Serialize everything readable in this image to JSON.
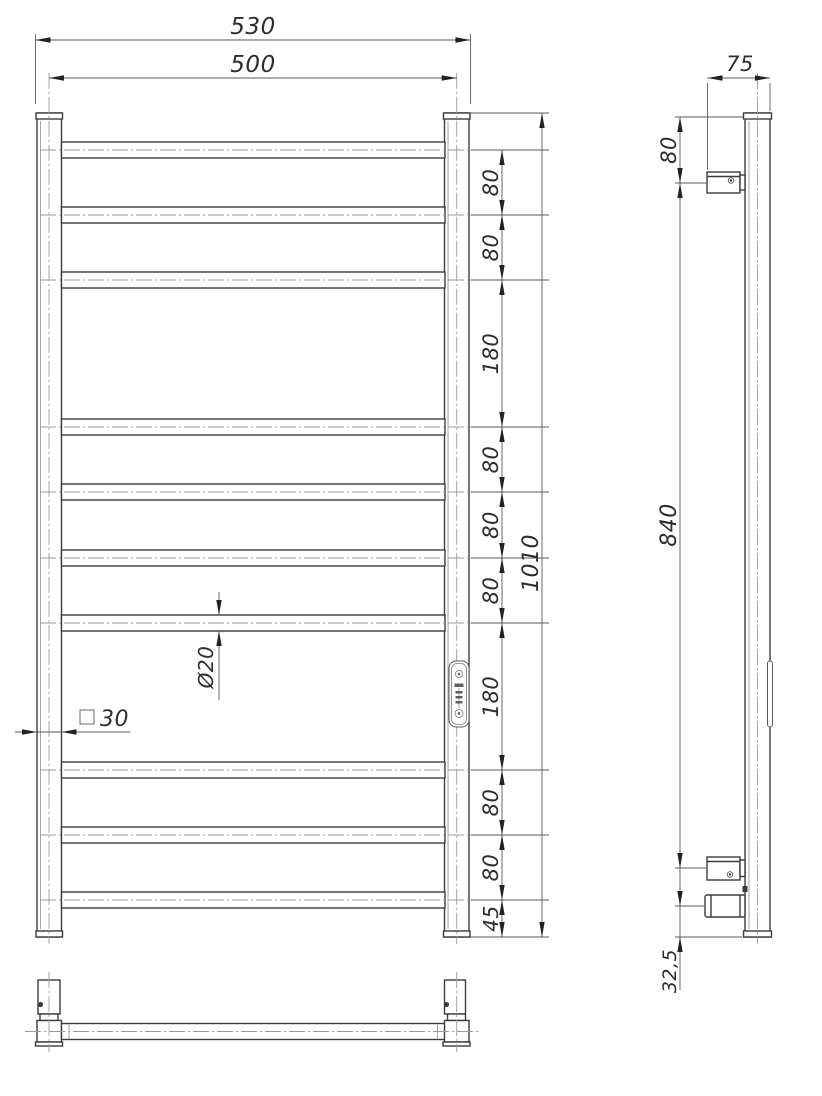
{
  "style": {
    "ink": "#3c3c3c",
    "background": "#ffffff"
  },
  "front_view": {
    "overall_width": "530",
    "centers_width": "500",
    "overall_height": "1010",
    "rung_spacing": [
      "80",
      "80",
      "180",
      "80",
      "80",
      "80",
      "180",
      "80",
      "80",
      "45"
    ],
    "rung_diameter": "Ø20",
    "post_square_size": "30"
  },
  "side_view": {
    "overall_depth": "75",
    "top_bracket_offset": "80",
    "bracket_span": "840",
    "bottom_fitting_offset": "32,5"
  }
}
